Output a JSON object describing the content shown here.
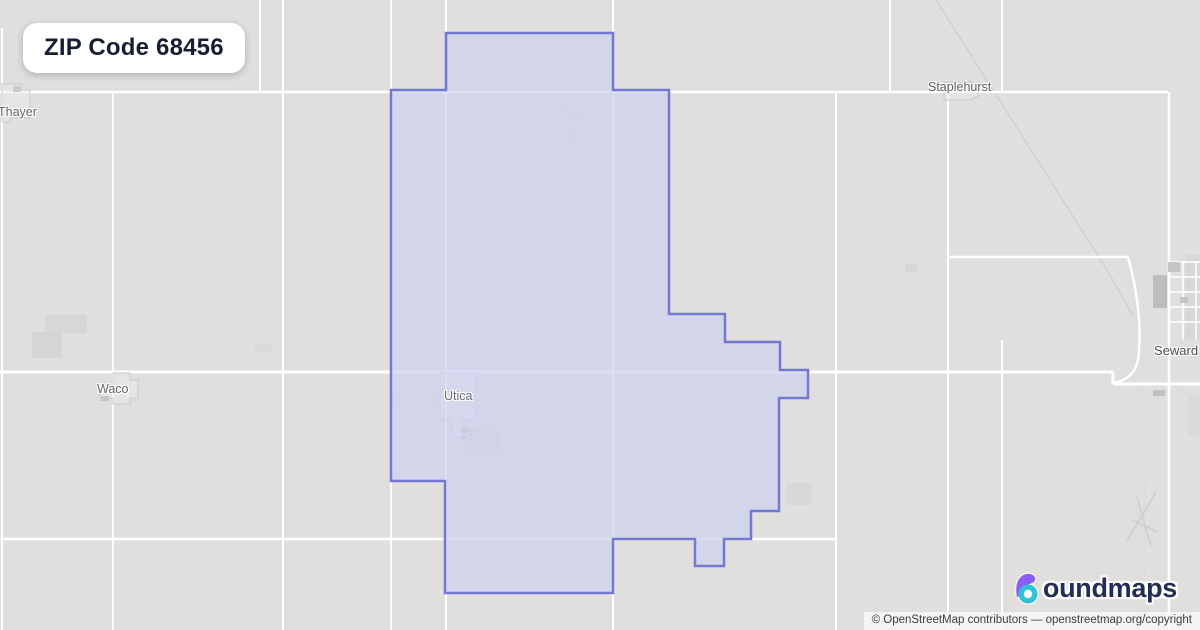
{
  "badge": {
    "title": "ZIP Code 68456"
  },
  "map": {
    "background_color": "#e0dfdd",
    "road_color": "#ffffff",
    "place_labels": {
      "thayer": "Thayer",
      "waco": "Waco",
      "utica": "Utica",
      "staplehurst": "Staplehurst",
      "seward": "Seward"
    },
    "zip_boundary": {
      "points": "446,33 613,33 613,90 669,90 669,314 725,314 725,342 780,342 780,370 808,370 808,398 779,398 779,511 751,511 751,539 724,539 724,566 695,566 695,539 613,539 613,593 445,593 445,481 391,481 391,90 446,90",
      "stroke_color": "#7478d2",
      "fill_color": "rgba(205,209,240,0.7)"
    }
  },
  "logo": {
    "brand": "boundmaps",
    "brand_rest": "oundmaps",
    "accent_purple": "#8b5cf6",
    "accent_teal": "#2fc3d4",
    "text_color": "#232e52"
  },
  "attribution": {
    "text": "© OpenStreetMap contributors — openstreetmap.org/copyright"
  }
}
